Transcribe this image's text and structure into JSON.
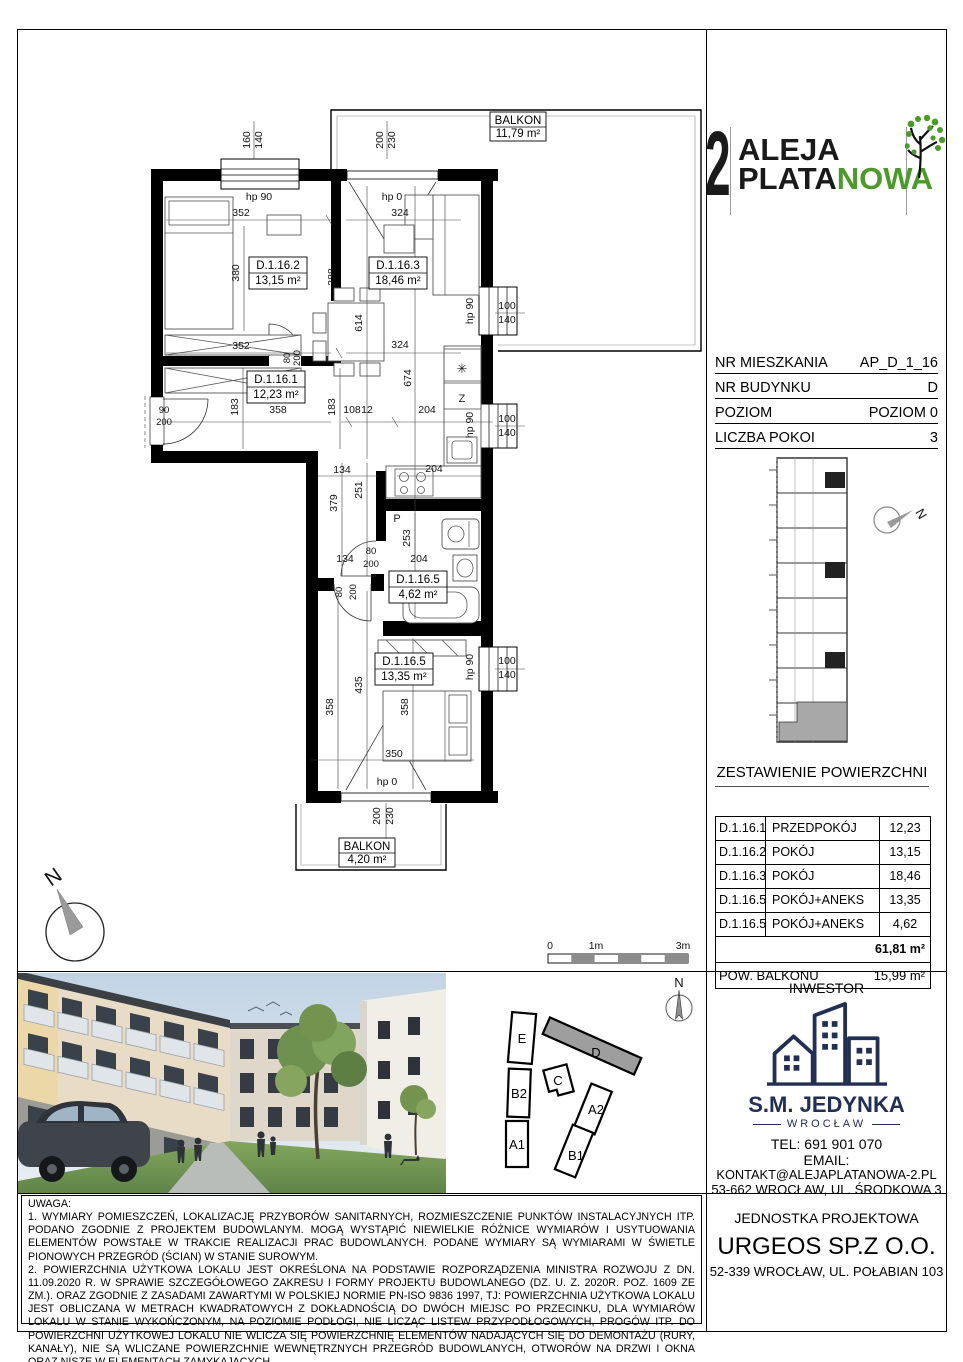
{
  "logo": {
    "number": "2",
    "line1": "ALEJA",
    "line2_black": "PLATA",
    "line2_green": "NOWA",
    "green_color": "#4a9b28"
  },
  "info": {
    "rows": [
      {
        "label": "NR MIESZKANIA",
        "value": "AP_D_1_16"
      },
      {
        "label": "NR BUDYNKU",
        "value": "D"
      },
      {
        "label": "POZIOM",
        "value": "POZIOM 0"
      },
      {
        "label": "LICZBA POKOI",
        "value": "3"
      }
    ]
  },
  "area_table": {
    "title": "ZESTAWIENIE POWIERZCHNI",
    "rows": [
      {
        "id": "D.1.16.1",
        "name": "PRZEDPOKÓJ",
        "value": "12,23"
      },
      {
        "id": "D.1.16.2",
        "name": "POKÓJ",
        "value": "13,15"
      },
      {
        "id": "D.1.16.3",
        "name": "POKÓJ",
        "value": "18,46"
      },
      {
        "id": "D.1.16.5",
        "name": "POKÓJ+ANEKS",
        "value": "13,35"
      },
      {
        "id": "D.1.16.5",
        "name": "POKÓJ+ANEKS",
        "value": "4,62"
      }
    ],
    "total": "61,81 m²",
    "balcony_label": "POW. BALKONU",
    "balcony_value": "15,99 m²"
  },
  "inwestor": {
    "title": "INWESTOR",
    "company": "S.M. JEDYNKA",
    "city": "WROCŁAW",
    "tel": "TEL: 691 901 070",
    "email_label": "EMAIL:",
    "email": "KONTAKT@ALEJAPLATANOWA-2.PL",
    "address": "53-662 WROCŁAW, UL. ŚRODKOWA 3",
    "navy_color": "#222f55"
  },
  "projektowa": {
    "title": "JEDNOSTKA PROJEKTOWA",
    "company": "URGEOS SP.Z O.O.",
    "address": "52-339 WROCŁAW, UL. POŁABIAN 103"
  },
  "notes": {
    "heading": "UWAGA:",
    "p1": "1. WYMIARY POMIESZCZEŃ, LOKALIZACJĘ PRZYBORÓW SANITARNYCH, ROZMIESZCZENIE PUNKTÓW INSTALACYJNYCH ITP. PODANO ZGODNIE Z PROJEKTEM BUDOWLANYM. MOGĄ WYSTĄPIĆ NIEWIELKIE RÓŻNICE WYMIARÓW I USYTUOWANIA ELEMENTÓW POWSTAŁE W TRAKCIE REALIZACJI PRAC BUDOWLANYCH. PODANE WYMIARY SĄ WYMIARAMI W ŚWIETLE PIONOWYCH PRZEGRÓD (ŚCIAN) W STANIE SUROWYM.",
    "p2": "2. POWIERZCHNIA UŻYTKOWA LOKALU JEST OKREŚLONA NA PODSTAWIE ROZPORZĄDZENIA MINISTRA ROZWOJU Z DN. 11.09.2020 R. W SPRAWIE SZCZEGÓŁOWEGO ZAKRESU I FORMY PROJEKTU BUDOWLANEGO (DZ. U. Z. 2020R. POZ. 1609 ZE ZM.). ORAZ ZGODNIE Z ZASADAMI ZAWARTYMI W POLSKIEJ NORMIE PN-ISO 9836 1997, TJ: POWIERZCHNIA UŻYTKOWA LOKALU JEST OBLICZANA W METRACH KWADRATOWYCH Z DOKŁADNOŚCIĄ DO DWÓCH MIEJSC PO PRZECINKU, DLA WYMIARÓW LOKALU W STANIE WYKOŃCZONYM, NA POZIOMIE PODŁOGI, NIE LICZĄC LISTEW PRZYPODŁOGOWYCH, PROGÓW ITP. DO POWIERZCHNI UŻYTKOWEJ LOKALU NIE WLICZA SIĘ POWIERZCHNIĘ ELEMENTÓW NADAJĄCYCH SIĘ DO DEMONTAŻU (RURY, KANAŁY), NIE SĄ WLICZANE POWIERZCHNIE WEWNĘTRZNYCH PRZEGRÓD BUDOWLANYCH, OTWORÓW NA DRZWI I OKNA ORAZ NISZE W ELEMENTACH ZAMYKAJĄCYCH.",
    "p3": "3. PRZEDSTAWIONA NA RZUCIE ARANŻACJA MA CHARAKTER PRZYKŁADOWY I UMEBLOWANIE NIE STANOWI WYPOSAŻENIA LOKALU."
  },
  "plan": {
    "rooms": {
      "r1": {
        "id": "D.1.16.1",
        "area": "12,23 m²"
      },
      "r2": {
        "id": "D.1.16.2",
        "area": "13,15 m²"
      },
      "r3": {
        "id": "D.1.16.3",
        "area": "18,46 m²"
      },
      "r5a": {
        "id": "D.1.16.5",
        "area": "4,62 m²"
      },
      "r5b": {
        "id": "D.1.16.5",
        "area": "13,35 m²"
      }
    },
    "balcony_top": {
      "name": "BALKON",
      "area": "11,79 m²"
    },
    "balcony_bottom": {
      "name": "BALKON",
      "area": "4,20 m²"
    },
    "dims": {
      "d160": "160",
      "d140": "140",
      "d200": "200",
      "d230": "230",
      "d352": "352",
      "d324": "324",
      "d380": "380",
      "d388": "388",
      "d614": "614",
      "d674": "674",
      "d183": "183",
      "d358": "358",
      "d108": "108",
      "d12": "12",
      "d204": "204",
      "d90": "90",
      "d134": "134",
      "d251": "251",
      "d379": "379",
      "d253": "253",
      "d80": "80",
      "d435": "435",
      "d350": "350",
      "d100": "100",
      "hp90": "hp 90",
      "hp0": "hp 0"
    },
    "symbols": {
      "fridge": "✳",
      "freezer": "Z",
      "washer": "P"
    },
    "scale": {
      "s0": "0",
      "s1": "1m",
      "s3": "3m"
    },
    "north": "N"
  },
  "site": {
    "north": "N",
    "buildings": {
      "e": "E",
      "b2": "B2",
      "a1": "A1",
      "c": "C",
      "d": "D",
      "a2": "A2",
      "b1": "B1"
    },
    "highlight_color": "#9e9e9e"
  },
  "miniplan": {
    "north": "N",
    "highlight_color": "#a8a8a8"
  }
}
